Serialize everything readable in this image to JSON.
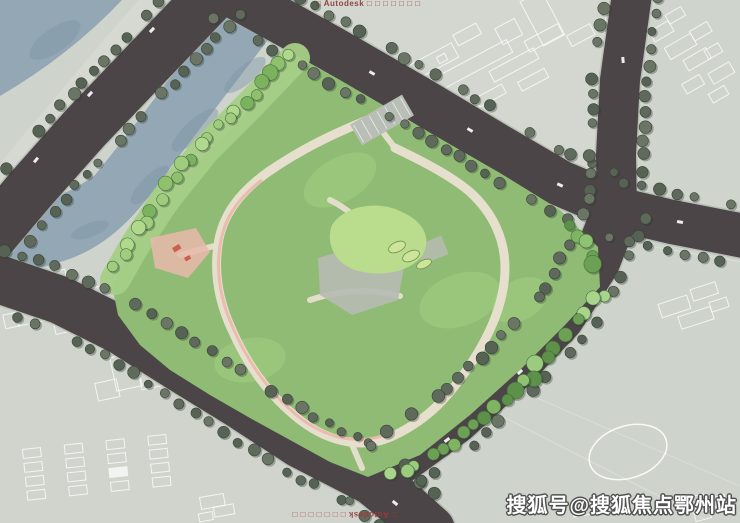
{
  "meta": {
    "type": "residential-master-site-plan",
    "width": 740,
    "height": 523
  },
  "watermarks": {
    "autodesk_top": "□ Autodesk □ □ □ □ □ □ □",
    "autodesk_bottom": "□ Autodesk □ □ □ □ □ □ □",
    "sohu": "搜狐号@搜狐焦点鄂州站"
  },
  "colors": {
    "parcel": "#ced3cc",
    "parcel_light": "#d6d9d2",
    "parcel_warm": "#d1d5cd",
    "road": "#4b4547",
    "curb": "#a8ada3",
    "water": "#93a7b4",
    "water_dark": "#7f96a6",
    "site_green": "#8fbb74",
    "bank_green": "#a5cf86",
    "lawn": "#b9dc8d",
    "path_cream": "#e7dfcd",
    "path_pink": "#e9b8ab",
    "plaza_gray": "#b6bbb2",
    "roof_white": "#f8f7f2",
    "roof_line": "#52524e",
    "pool_blue": "#7cb2d8",
    "boundary_blue": "#3a64cf",
    "boundary_red": "#d4695c",
    "boundary_purple": "#6a3ec2",
    "cad_line": "#ffffff",
    "tree_street": [
      "#5f6a5c",
      "#566354",
      "#6a7565"
    ],
    "tree_site": [
      "#7fb562",
      "#8fc272",
      "#6da054",
      "#9ccb80",
      "#5d9049",
      "#a8d48b"
    ],
    "tree_bank": [
      "#8fc06c",
      "#a0cd7d",
      "#7bb25e",
      "#b0d98e"
    ]
  },
  "annotations": [
    {
      "text": "道路红线",
      "x": 492,
      "y": 166,
      "size": 4.5,
      "leader": null
    },
    {
      "text": "用地红线",
      "x": 552,
      "y": 178,
      "size": 5,
      "leader": [
        551,
        180,
        522,
        187
      ]
    },
    {
      "text": "建筑控制线",
      "x": 554,
      "y": 192,
      "size": 5,
      "leader": [
        553,
        194,
        524,
        201
      ]
    },
    {
      "text": "高层住宅",
      "x": 558,
      "y": 233,
      "size": 5,
      "leader": [
        556,
        235,
        468,
        241
      ]
    },
    {
      "text": "地下车库范围线",
      "x": 542,
      "y": 255,
      "size": 5,
      "leader": [
        540,
        257,
        505,
        263
      ]
    }
  ],
  "buildings": [
    {
      "name": "north-slab",
      "cx": 331,
      "cy": 146,
      "len": 92,
      "wid": 25,
      "rot": -41,
      "kind": "slab"
    },
    {
      "name": "west-slab",
      "cx": 244,
      "cy": 229,
      "len": 94,
      "wid": 25,
      "rot": -36,
      "kind": "slab"
    },
    {
      "name": "east-slab",
      "cx": 489,
      "cy": 243,
      "len": 80,
      "wid": 24,
      "rot": -33,
      "kind": "slab"
    },
    {
      "name": "southeast-slab",
      "cx": 425,
      "cy": 331,
      "len": 80,
      "wid": 24,
      "rot": -33,
      "kind": "slab"
    },
    {
      "name": "south-slab",
      "cx": 359,
      "cy": 408,
      "len": 80,
      "wid": 24,
      "rot": -31,
      "kind": "slab"
    },
    {
      "name": "community-center",
      "cx": 299,
      "cy": 327,
      "len": 100,
      "wid": 52,
      "rot": 64,
      "kind": "big"
    },
    {
      "name": "triangle-building",
      "pts": [
        [
          399,
          149
        ],
        [
          468,
          207
        ],
        [
          403,
          221
        ]
      ],
      "kind": "triangle"
    },
    {
      "name": "guard-house",
      "cx": 233,
      "cy": 99,
      "len": 15,
      "wid": 9,
      "rot": -40,
      "kind": "dark"
    }
  ],
  "birds": [
    {
      "x": 158,
      "y": 112,
      "s": 1.3
    },
    {
      "x": 204,
      "y": 130,
      "s": 1.1
    },
    {
      "x": 238,
      "y": 93,
      "s": 0.9
    },
    {
      "x": 83,
      "y": 150,
      "s": 0.8
    }
  ]
}
